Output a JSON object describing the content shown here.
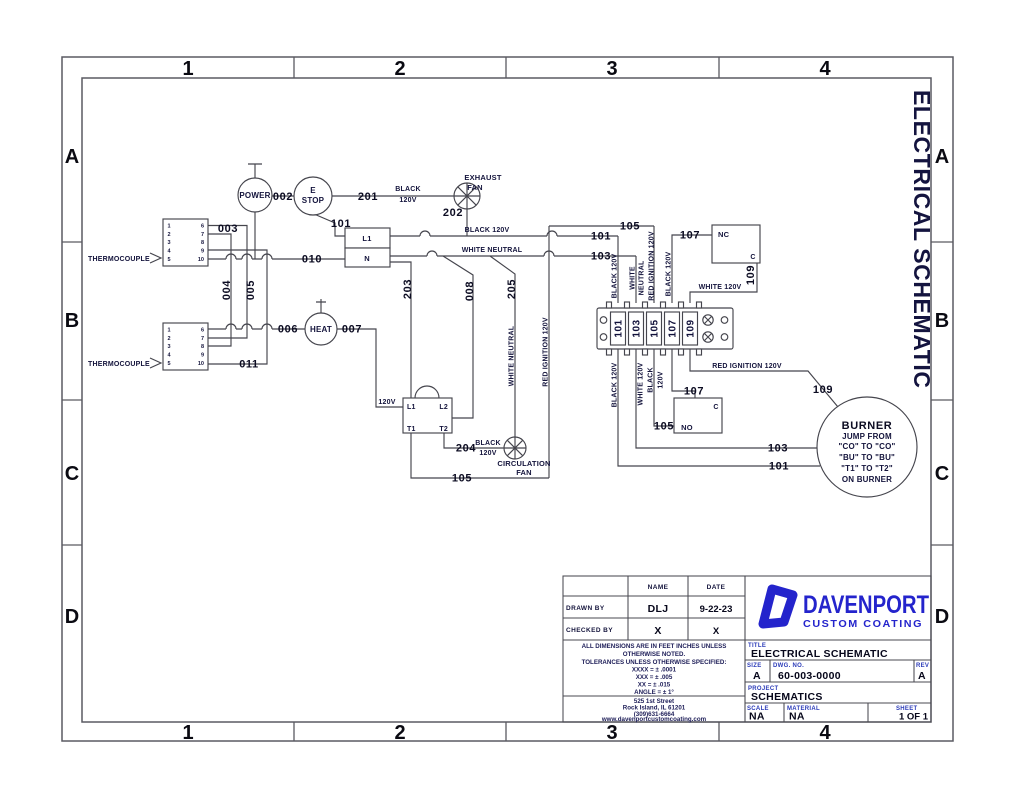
{
  "frame": {
    "cols": [
      "1",
      "2",
      "3",
      "4"
    ],
    "rows": [
      "A",
      "B",
      "C",
      "D"
    ],
    "side_title": "ELECTRICAL SCHEMATIC"
  },
  "w": {
    "002": "002",
    "003": "003",
    "004": "004",
    "005": "005",
    "006": "006",
    "007": "007",
    "008": "008",
    "010": "010",
    "011": "011",
    "101": "101",
    "103": "103",
    "105": "105",
    "107": "107",
    "109": "109",
    "201": "201",
    "202": "202",
    "203": "203",
    "204": "204",
    "205": "205"
  },
  "p": {
    "black": "BLACK",
    "v120": "120V",
    "black120": "BLACK 120V",
    "white_neutral": "WHITE NEUTRAL",
    "white": "WHITE",
    "neutral": "NEUTRAL",
    "white120": "WHITE 120V",
    "red_ign": "RED IGNITION 120V"
  },
  "comp": {
    "power": "POWER",
    "estop1": "E",
    "estop2": "STOP",
    "heat": "HEAT",
    "exh1": "EXHAUST",
    "exh2": "FAN",
    "circ1": "CIRCULATION",
    "circ2": "FAN",
    "tc": "THERMOCOUPLE",
    "relay_l1": "L1",
    "relay_n": "N",
    "x_l1": "L1",
    "x_l2": "L2",
    "x_t1": "T1",
    "x_t2": "T2",
    "x_v": "120V",
    "nc": "NC",
    "c": "C",
    "no": "NO",
    "pins_l": [
      "1",
      "2",
      "3",
      "4",
      "5"
    ],
    "pins_r": [
      "6",
      "7",
      "8",
      "9",
      "10"
    ],
    "terminals": [
      "101",
      "103",
      "105",
      "107",
      "109"
    ],
    "burner": "BURNER",
    "burner_l1": "JUMP FROM",
    "burner_l2": "\"CO\" TO \"CO\"",
    "burner_l3": "\"BU\" TO \"BU\"",
    "burner_l4": "\"T1\" TO \"T2\"",
    "burner_l5": "ON BURNER"
  },
  "tb": {
    "name": "NAME",
    "date": "DATE",
    "drawn_label": "DRAWN BY",
    "drawn_name": "DLJ",
    "drawn_date": "9-22-23",
    "checked_label": "CHECKED BY",
    "checked_name": "X",
    "checked_date": "X",
    "notes": [
      "ALL DIMENSIONS ARE IN FEET INCHES UNLESS",
      "OTHERWISE NOTED.",
      "TOLERANCES UNLESS OTHERWISE SPECIFIED:",
      "XXXX = ± .0001",
      "XXX = ± .005",
      "XX = ± .015",
      "ANGLE = ± 1°"
    ],
    "address": [
      "525 1st Street",
      "Rock Island, IL 61201",
      "(309)631-6664",
      "www.davenportcustomcoating.com"
    ],
    "brand": "DAVENPORT",
    "brand2": "CUSTOM COATING",
    "title_label": "TITLE",
    "title": "ELECTRICAL SCHEMATIC",
    "size_label": "SIZE",
    "size": "A",
    "dwg_label": "DWG. NO.",
    "dwg": "60-003-0000",
    "rev_label": "REV",
    "rev": "A",
    "project_label": "PROJECT",
    "project": "SCHEMATICS",
    "scale_label": "SCALE",
    "scale": "NA",
    "material_label": "MATERIAL",
    "material": "NA",
    "sheet_label": "SHEET",
    "sheet": "1 OF 1"
  },
  "colors": {
    "brand_blue": "#2424cc",
    "line_gray": "#45454d"
  }
}
